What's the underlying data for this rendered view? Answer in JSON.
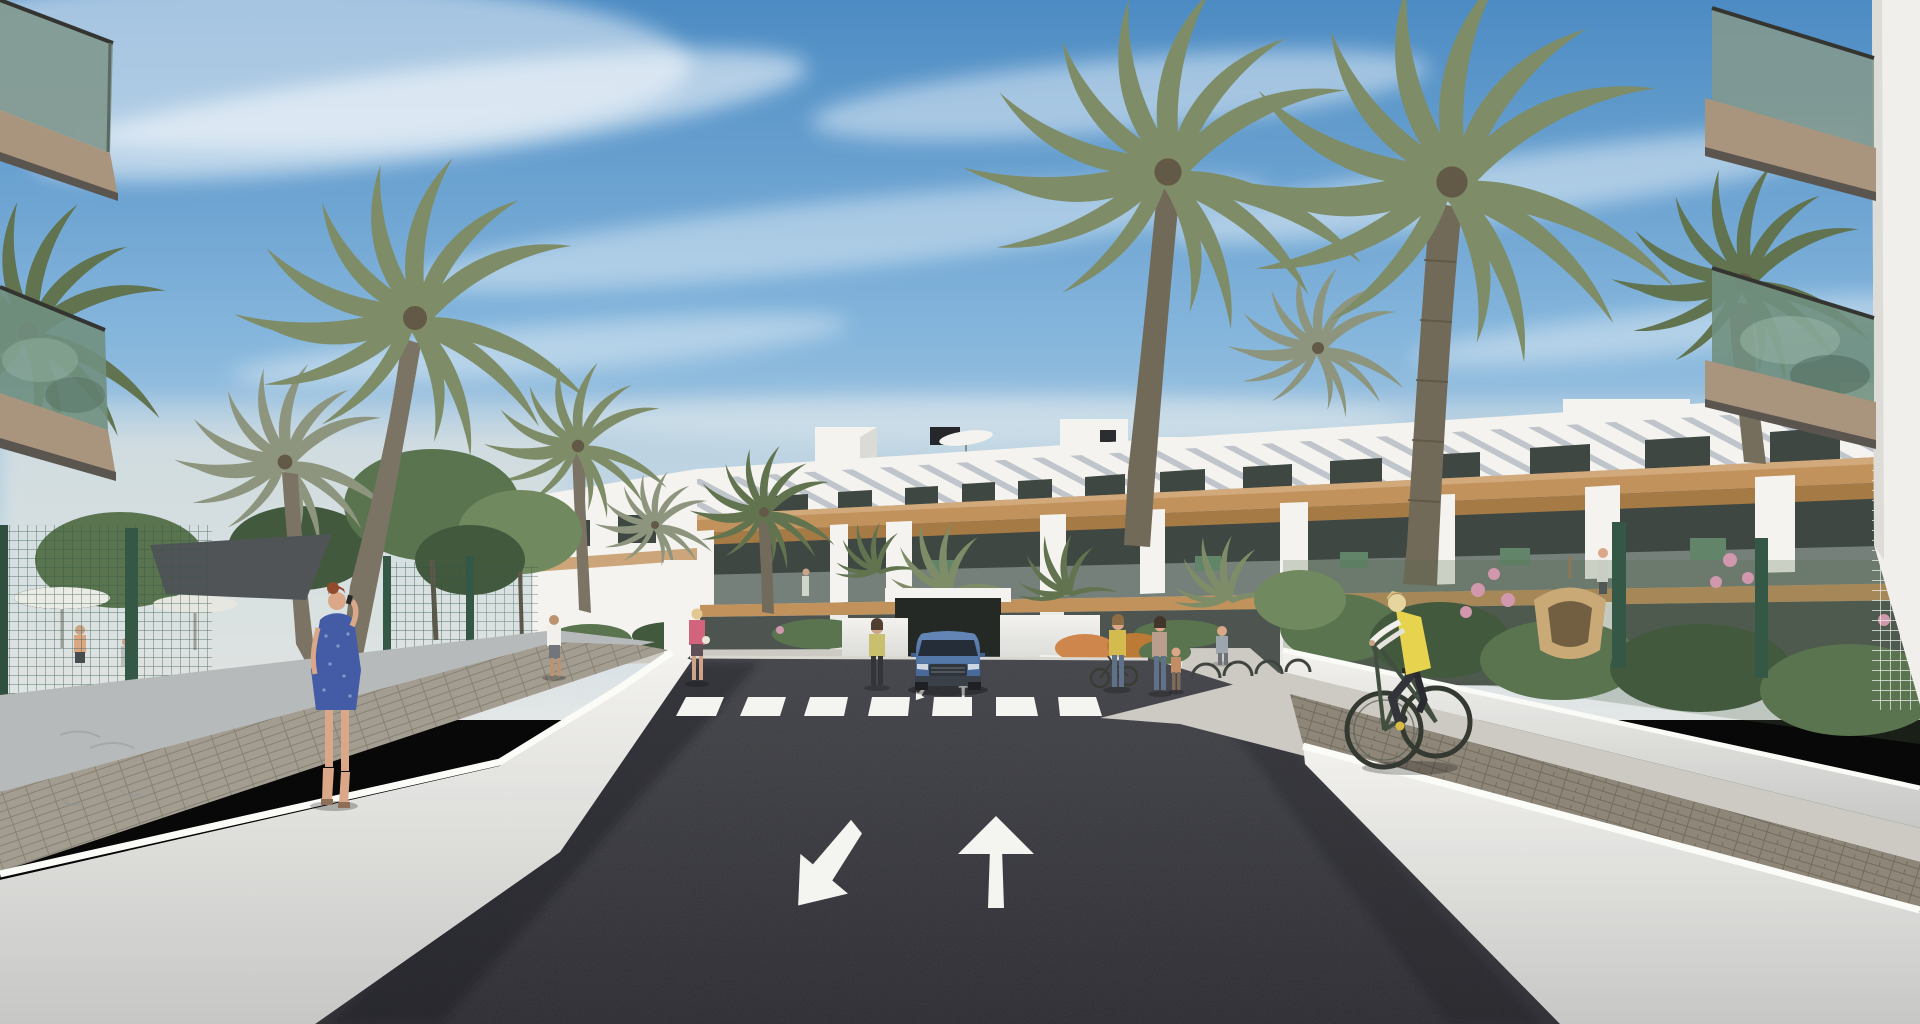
{
  "meta": {
    "title": "Residential complex street rendering",
    "description": "3D architectural visualization: a modern white three-storey apartment complex with wood-clad balcony bands and rooftop terraces, fronted by tall palm trees. A dark two-way asphalt road with a white straight-ahead arrow, a turn arrow, and a zebra crosswalk leads to an underground parking ramp where a blue SUV exits. White planter walls flank the road; a woman in a blue dress walks on the left sidewalk talking on a phone, a cyclist in a yellow vest rides on the right paver path, and small groups of pedestrians stand near bike racks. Glass-railed balconies of foreground buildings frame the top corners under a blue sky with wispy clouds.",
    "width_px": 1920,
    "height_px": 1024
  },
  "palette": {
    "sky_top": "#4788c2",
    "sky_mid": "#7fb2da",
    "sky_low": "#b9d3e6",
    "haze": "#e3e7e6",
    "cloud": "#ffffff",
    "bldg_white": "#f4f3ef",
    "bldg_shade": "#d9dad6",
    "louver": "#b4bcc3",
    "window_dark": "#39423d",
    "wood": "#c08f58",
    "wood_dark": "#a4763f",
    "glass_teal": "#7e968c",
    "glass_green": "#6d8d7c",
    "slab_tan": "#a7927a",
    "wall_white": "#efeeea",
    "wall_light": "#d6d5d0",
    "wall_gray": "#b5b8b8",
    "pave_light": "#cbc9c2",
    "paver_brown": "#8b8375",
    "asphalt_hi": "#3a3b41",
    "asphalt_lo": "#232329",
    "marking": "#f4f4f1",
    "fence_green": "#2f5340",
    "mesh_white": "#e9ece9",
    "palm_dark": "#5c6f4a",
    "palm_mid": "#7a8a63",
    "palm_gray": "#8a927a",
    "trunk": "#77705f",
    "foliage_dark": "#3d5438",
    "foliage_mid": "#54704a",
    "foliage_light": "#6d865a",
    "flower_pink": "#d094ab",
    "flower_orange": "#cd8347",
    "sail": "#4b4f52",
    "car_blue": "#486da0",
    "car_dark": "#20293а",
    "skin": "#d9a585",
    "hair_red": "#8d4726",
    "dress_blue": "#3d57a3",
    "vest_yellow": "#e8d24a",
    "shirt_white": "#f1f0ec",
    "pants_dark": "#2d2e33",
    "jeans": "#5b6d87",
    "pink_jacket": "#d16079",
    "shadow": "#15161a"
  },
  "scene": {
    "setting": "modern apartment complex street view, sunny day",
    "objects": [
      "sky with cirrus clouds",
      "central white apartment building with rooftop parasols and chimneys",
      "foreground balconies with glass railings (top-left and top-right)",
      "palm trees",
      "green mesh fences",
      "white planter walls",
      "asphalt road with two lane arrows and zebra crosswalk",
      "underground parking ramp",
      "blue SUV",
      "pedestrians",
      "cyclist",
      "garden with pink and orange flowers",
      "hanging wicker chair",
      "shade sail and patio umbrellas"
    ],
    "road_markings": {
      "straight_arrow": "pointing away from viewer",
      "turn_arrow": "pointing toward lower-left",
      "crosswalk_stripe_count": 7
    },
    "vehicle": {
      "type": "SUV",
      "color_name": "blue"
    },
    "people_count": 13,
    "palm_tree_count": 10
  }
}
